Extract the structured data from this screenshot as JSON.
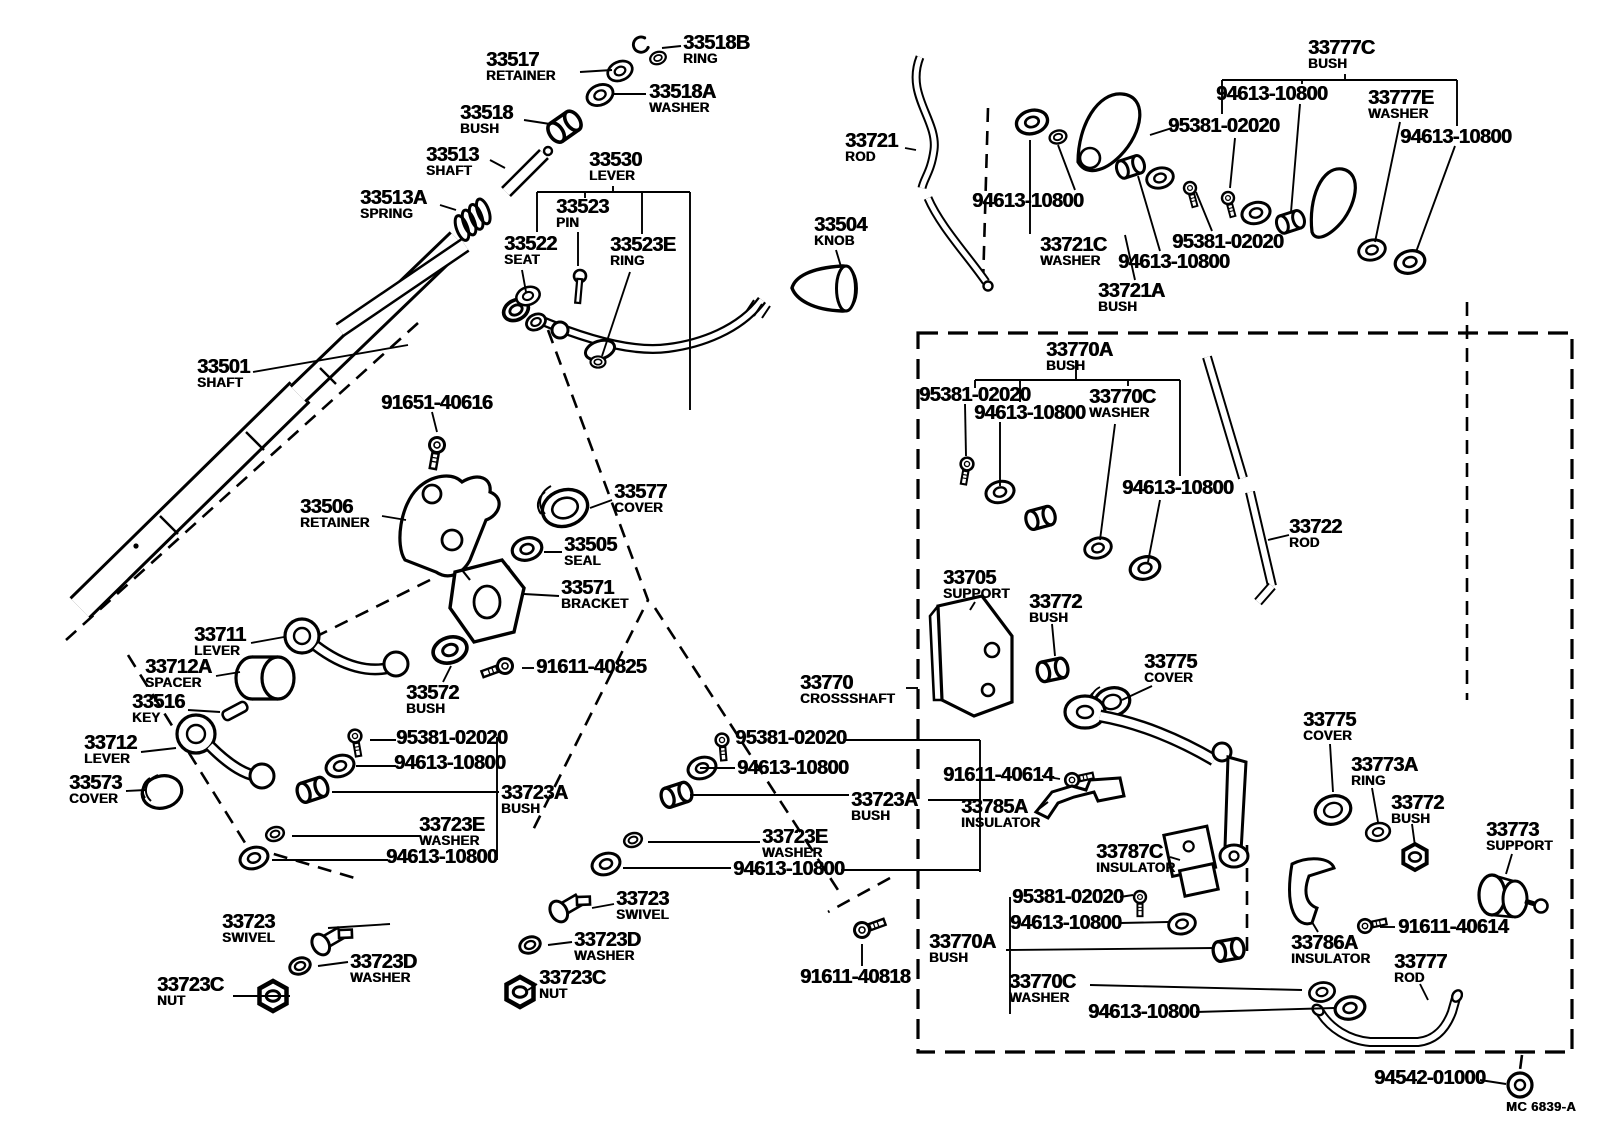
{
  "colors": {
    "ink": "#000000",
    "paper": "#ffffff"
  },
  "footer": {
    "code": "MC 6839-A"
  },
  "labels": [
    {
      "num": "33518B",
      "name": "RING",
      "x": 683,
      "y": 34
    },
    {
      "num": "33517",
      "name": "RETAINER",
      "x": 486,
      "y": 51
    },
    {
      "num": "33518A",
      "name": "WASHER",
      "x": 649,
      "y": 83
    },
    {
      "num": "33518",
      "name": "BUSH",
      "x": 460,
      "y": 104
    },
    {
      "num": "33513",
      "name": "SHAFT",
      "x": 426,
      "y": 146
    },
    {
      "num": "33530",
      "name": "LEVER",
      "x": 589,
      "y": 151
    },
    {
      "num": "33513A",
      "name": "SPRING",
      "x": 360,
      "y": 189
    },
    {
      "num": "33523",
      "name": "PIN",
      "x": 556,
      "y": 198
    },
    {
      "num": "33522",
      "name": "SEAT",
      "x": 504,
      "y": 235
    },
    {
      "num": "33523E",
      "name": "RING",
      "x": 610,
      "y": 236
    },
    {
      "num": "33504",
      "name": "KNOB",
      "x": 814,
      "y": 216
    },
    {
      "num": "33721",
      "name": "ROD",
      "x": 845,
      "y": 132
    },
    {
      "num": "94613-10800",
      "name": "",
      "x": 972,
      "y": 192
    },
    {
      "num": "33721C",
      "name": "WASHER",
      "x": 1040,
      "y": 236
    },
    {
      "num": "94613-10800",
      "name": "",
      "x": 1118,
      "y": 253
    },
    {
      "num": "33721A",
      "name": "BUSH",
      "x": 1098,
      "y": 282
    },
    {
      "num": "95381-02020",
      "name": "",
      "x": 1168,
      "y": 117
    },
    {
      "num": "33777C",
      "name": "BUSH",
      "x": 1308,
      "y": 39
    },
    {
      "num": "94613-10800",
      "name": "",
      "x": 1216,
      "y": 85
    },
    {
      "num": "33777E",
      "name": "WASHER",
      "x": 1368,
      "y": 89
    },
    {
      "num": "94613-10800",
      "name": "",
      "x": 1400,
      "y": 128
    },
    {
      "num": "95381-02020",
      "name": "",
      "x": 1172,
      "y": 233
    },
    {
      "num": "33501",
      "name": "SHAFT",
      "x": 197,
      "y": 358
    },
    {
      "num": "91651-40616",
      "name": "",
      "x": 381,
      "y": 394
    },
    {
      "num": "33506",
      "name": "RETAINER",
      "x": 300,
      "y": 498
    },
    {
      "num": "33577",
      "name": "COVER",
      "x": 614,
      "y": 483
    },
    {
      "num": "33505",
      "name": "SEAL",
      "x": 564,
      "y": 536
    },
    {
      "num": "33571",
      "name": "BRACKET",
      "x": 561,
      "y": 579
    },
    {
      "num": "33711",
      "name": "LEVER",
      "x": 194,
      "y": 626
    },
    {
      "num": "33712A",
      "name": "SPACER",
      "x": 145,
      "y": 658
    },
    {
      "num": "33516",
      "name": "KEY",
      "x": 132,
      "y": 693
    },
    {
      "num": "33712",
      "name": "LEVER",
      "x": 84,
      "y": 734
    },
    {
      "num": "33573",
      "name": "COVER",
      "x": 69,
      "y": 774
    },
    {
      "num": "33572",
      "name": "BUSH",
      "x": 406,
      "y": 684
    },
    {
      "num": "91611-40825",
      "name": "",
      "x": 536,
      "y": 658
    },
    {
      "num": "95381-02020",
      "name": "",
      "x": 396,
      "y": 729
    },
    {
      "num": "94613-10800",
      "name": "",
      "x": 394,
      "y": 754
    },
    {
      "num": "33723A",
      "name": "BUSH",
      "x": 501,
      "y": 784
    },
    {
      "num": "33723E",
      "name": "WASHER",
      "x": 419,
      "y": 816
    },
    {
      "num": "94613-10800",
      "name": "",
      "x": 386,
      "y": 848
    },
    {
      "num": "33723",
      "name": "SWIVEL",
      "x": 222,
      "y": 913
    },
    {
      "num": "33723D",
      "name": "WASHER",
      "x": 350,
      "y": 953
    },
    {
      "num": "33723C",
      "name": "NUT",
      "x": 157,
      "y": 976
    },
    {
      "num": "95381-02020",
      "name": "",
      "x": 735,
      "y": 729
    },
    {
      "num": "94613-10800",
      "name": "",
      "x": 737,
      "y": 759
    },
    {
      "num": "33723A",
      "name": "BUSH",
      "x": 851,
      "y": 791
    },
    {
      "num": "33723E",
      "name": "WASHER",
      "x": 762,
      "y": 828
    },
    {
      "num": "94613-10800",
      "name": "",
      "x": 733,
      "y": 860
    },
    {
      "num": "33723",
      "name": "SWIVEL",
      "x": 616,
      "y": 890
    },
    {
      "num": "33723D",
      "name": "WASHER",
      "x": 574,
      "y": 931
    },
    {
      "num": "33723C",
      "name": "NUT",
      "x": 539,
      "y": 969
    },
    {
      "num": "91611-40818",
      "name": "",
      "x": 800,
      "y": 968
    },
    {
      "num": "33770A",
      "name": "BUSH",
      "x": 1046,
      "y": 341
    },
    {
      "num": "95381-02020",
      "name": "",
      "x": 919,
      "y": 386
    },
    {
      "num": "94613-10800",
      "name": "",
      "x": 974,
      "y": 404
    },
    {
      "num": "33770C",
      "name": "WASHER",
      "x": 1089,
      "y": 388
    },
    {
      "num": "94613-10800",
      "name": "",
      "x": 1122,
      "y": 479
    },
    {
      "num": "33722",
      "name": "ROD",
      "x": 1289,
      "y": 518
    },
    {
      "num": "33705",
      "name": "SUPPORT",
      "x": 943,
      "y": 569
    },
    {
      "num": "33772",
      "name": "BUSH",
      "x": 1029,
      "y": 593
    },
    {
      "num": "33770",
      "name": "CROSSSHAFT",
      "x": 800,
      "y": 674
    },
    {
      "num": "91611-40614",
      "name": "",
      "x": 943,
      "y": 766
    },
    {
      "num": "33775",
      "name": "COVER",
      "x": 1144,
      "y": 653
    },
    {
      "num": "33775",
      "name": "COVER",
      "x": 1303,
      "y": 711
    },
    {
      "num": "33773A",
      "name": "RING",
      "x": 1351,
      "y": 756
    },
    {
      "num": "33772",
      "name": "BUSH",
      "x": 1391,
      "y": 794
    },
    {
      "num": "33773",
      "name": "SUPPORT",
      "x": 1486,
      "y": 821
    },
    {
      "num": "33785A",
      "name": "INSULATOR",
      "x": 961,
      "y": 798
    },
    {
      "num": "33787C",
      "name": "INSULATOR",
      "x": 1096,
      "y": 843
    },
    {
      "num": "95381-02020",
      "name": "",
      "x": 1012,
      "y": 888
    },
    {
      "num": "94613-10800",
      "name": "",
      "x": 1010,
      "y": 914
    },
    {
      "num": "33770A",
      "name": "BUSH",
      "x": 929,
      "y": 933
    },
    {
      "num": "33770C",
      "name": "WASHER",
      "x": 1009,
      "y": 973
    },
    {
      "num": "94613-10800",
      "name": "",
      "x": 1088,
      "y": 1003
    },
    {
      "num": "33786A",
      "name": "INSULATOR",
      "x": 1291,
      "y": 934
    },
    {
      "num": "91611-40614",
      "name": "",
      "x": 1398,
      "y": 918
    },
    {
      "num": "33777",
      "name": "ROD",
      "x": 1394,
      "y": 953
    },
    {
      "num": "94542-01000",
      "name": "",
      "x": 1374,
      "y": 1069
    }
  ]
}
